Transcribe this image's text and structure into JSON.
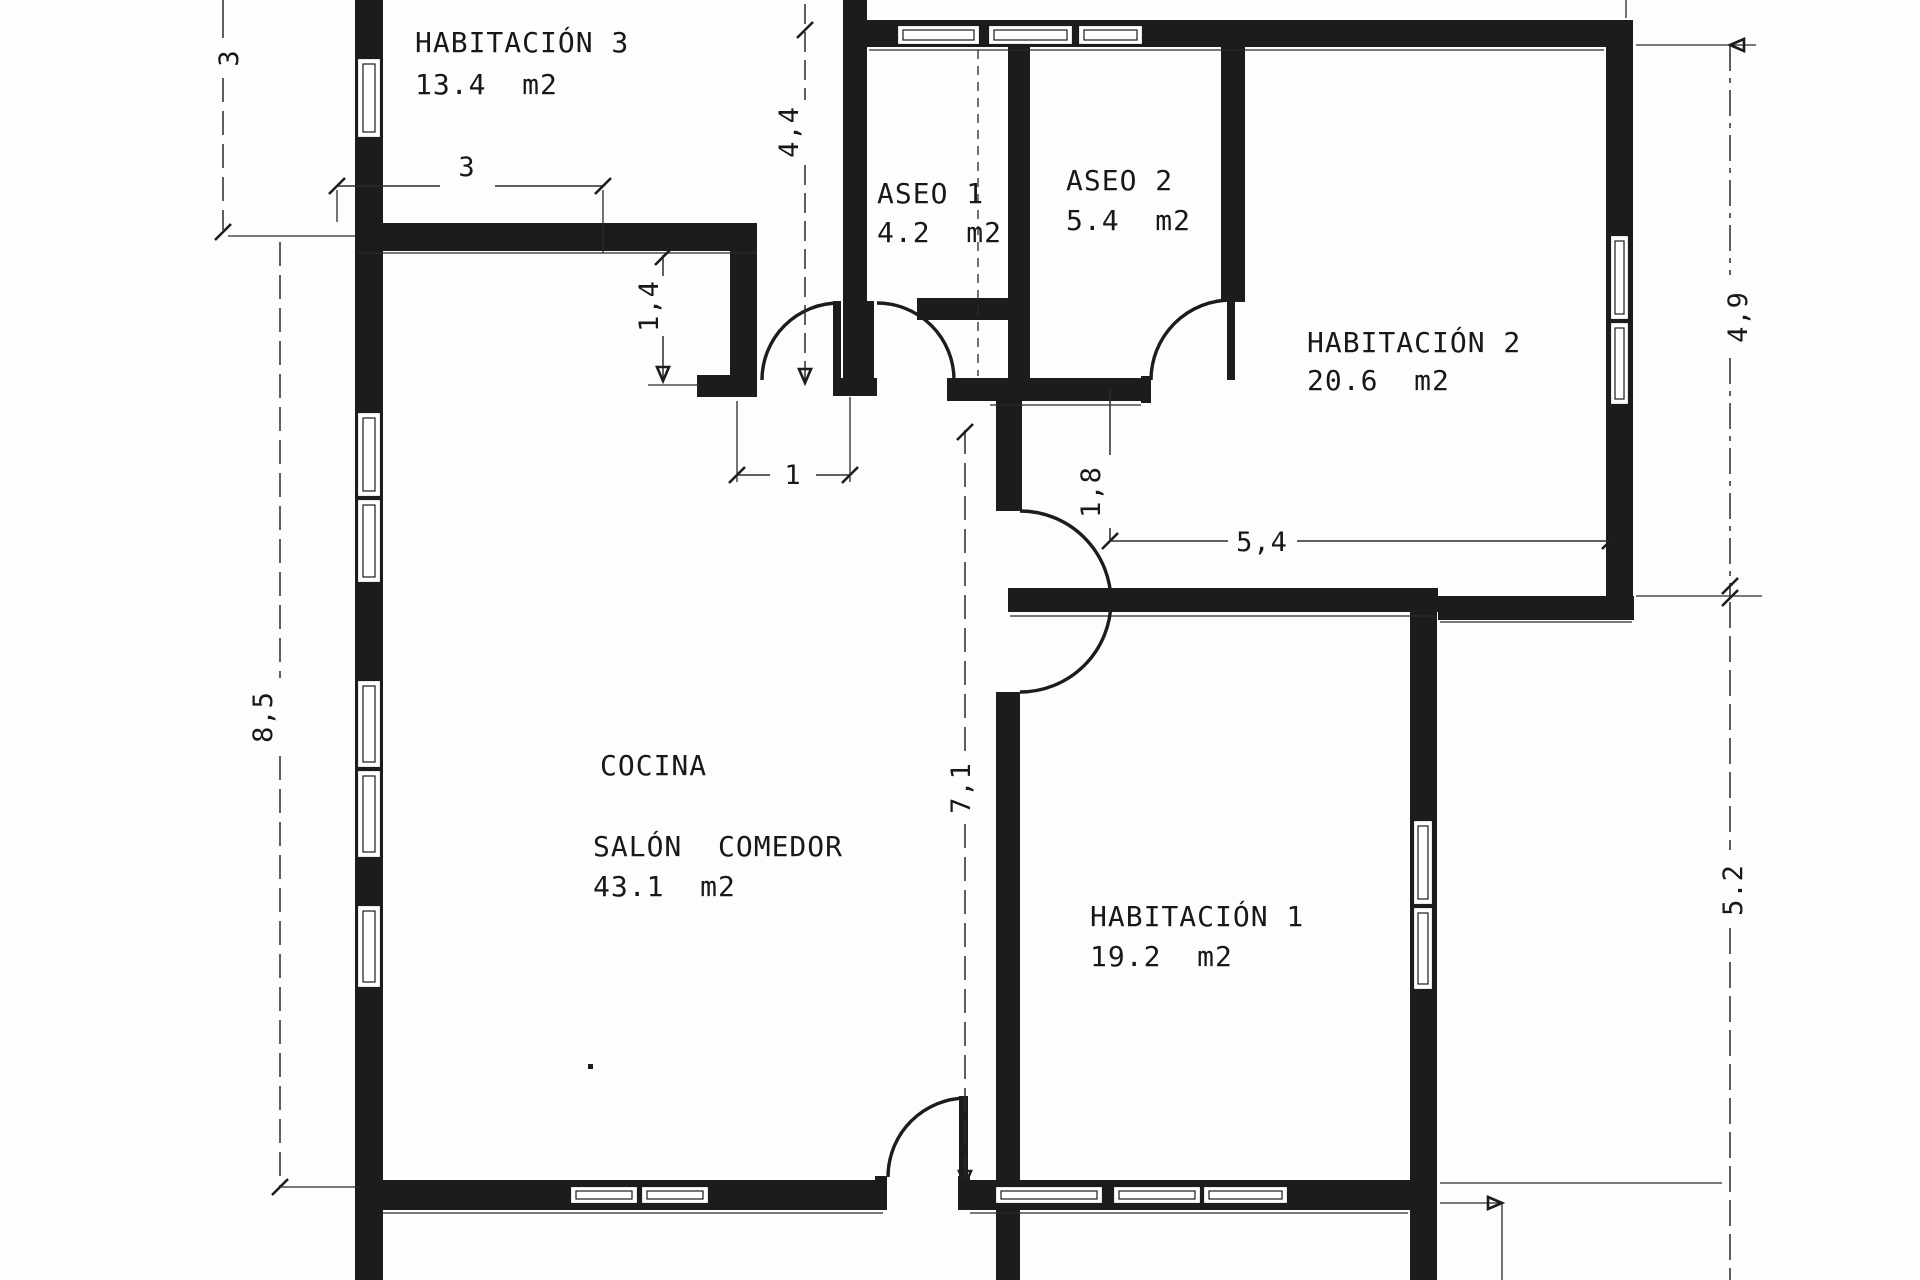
{
  "drawing": {
    "kind": "architectural floor plan",
    "unit": "m",
    "ink_color": "#1c1c1c",
    "paper_color": "#fdfdfc"
  },
  "rooms": {
    "habitacion3": {
      "name": "HABITACIÓN 3",
      "area": "13.4  m2"
    },
    "aseo1": {
      "name": "ASEO 1",
      "area": "4.2  m2"
    },
    "aseo2": {
      "name": "ASEO 2",
      "area": "5.4  m2"
    },
    "habitacion2": {
      "name": "HABITACIÓN 2",
      "area": "20.6  m2"
    },
    "cocina": {
      "name": "COCINA"
    },
    "salon": {
      "name": "SALÓN  COMEDOR",
      "area": "43.1  m2"
    },
    "habitacion1": {
      "name": "HABITACIÓN 1",
      "area": "19.2  m2"
    }
  },
  "dimensions": {
    "top_left_height": "3",
    "hab3_width": "3",
    "corridor_height": "4,4",
    "kitchen_jog": "1,4",
    "door_width": "1",
    "hall_width": "1,8",
    "hab2_width": "5,4",
    "right_upper_height": "4,9",
    "left_height": "8,5",
    "center_height": "7,1",
    "right_lower_height": "5.2"
  }
}
